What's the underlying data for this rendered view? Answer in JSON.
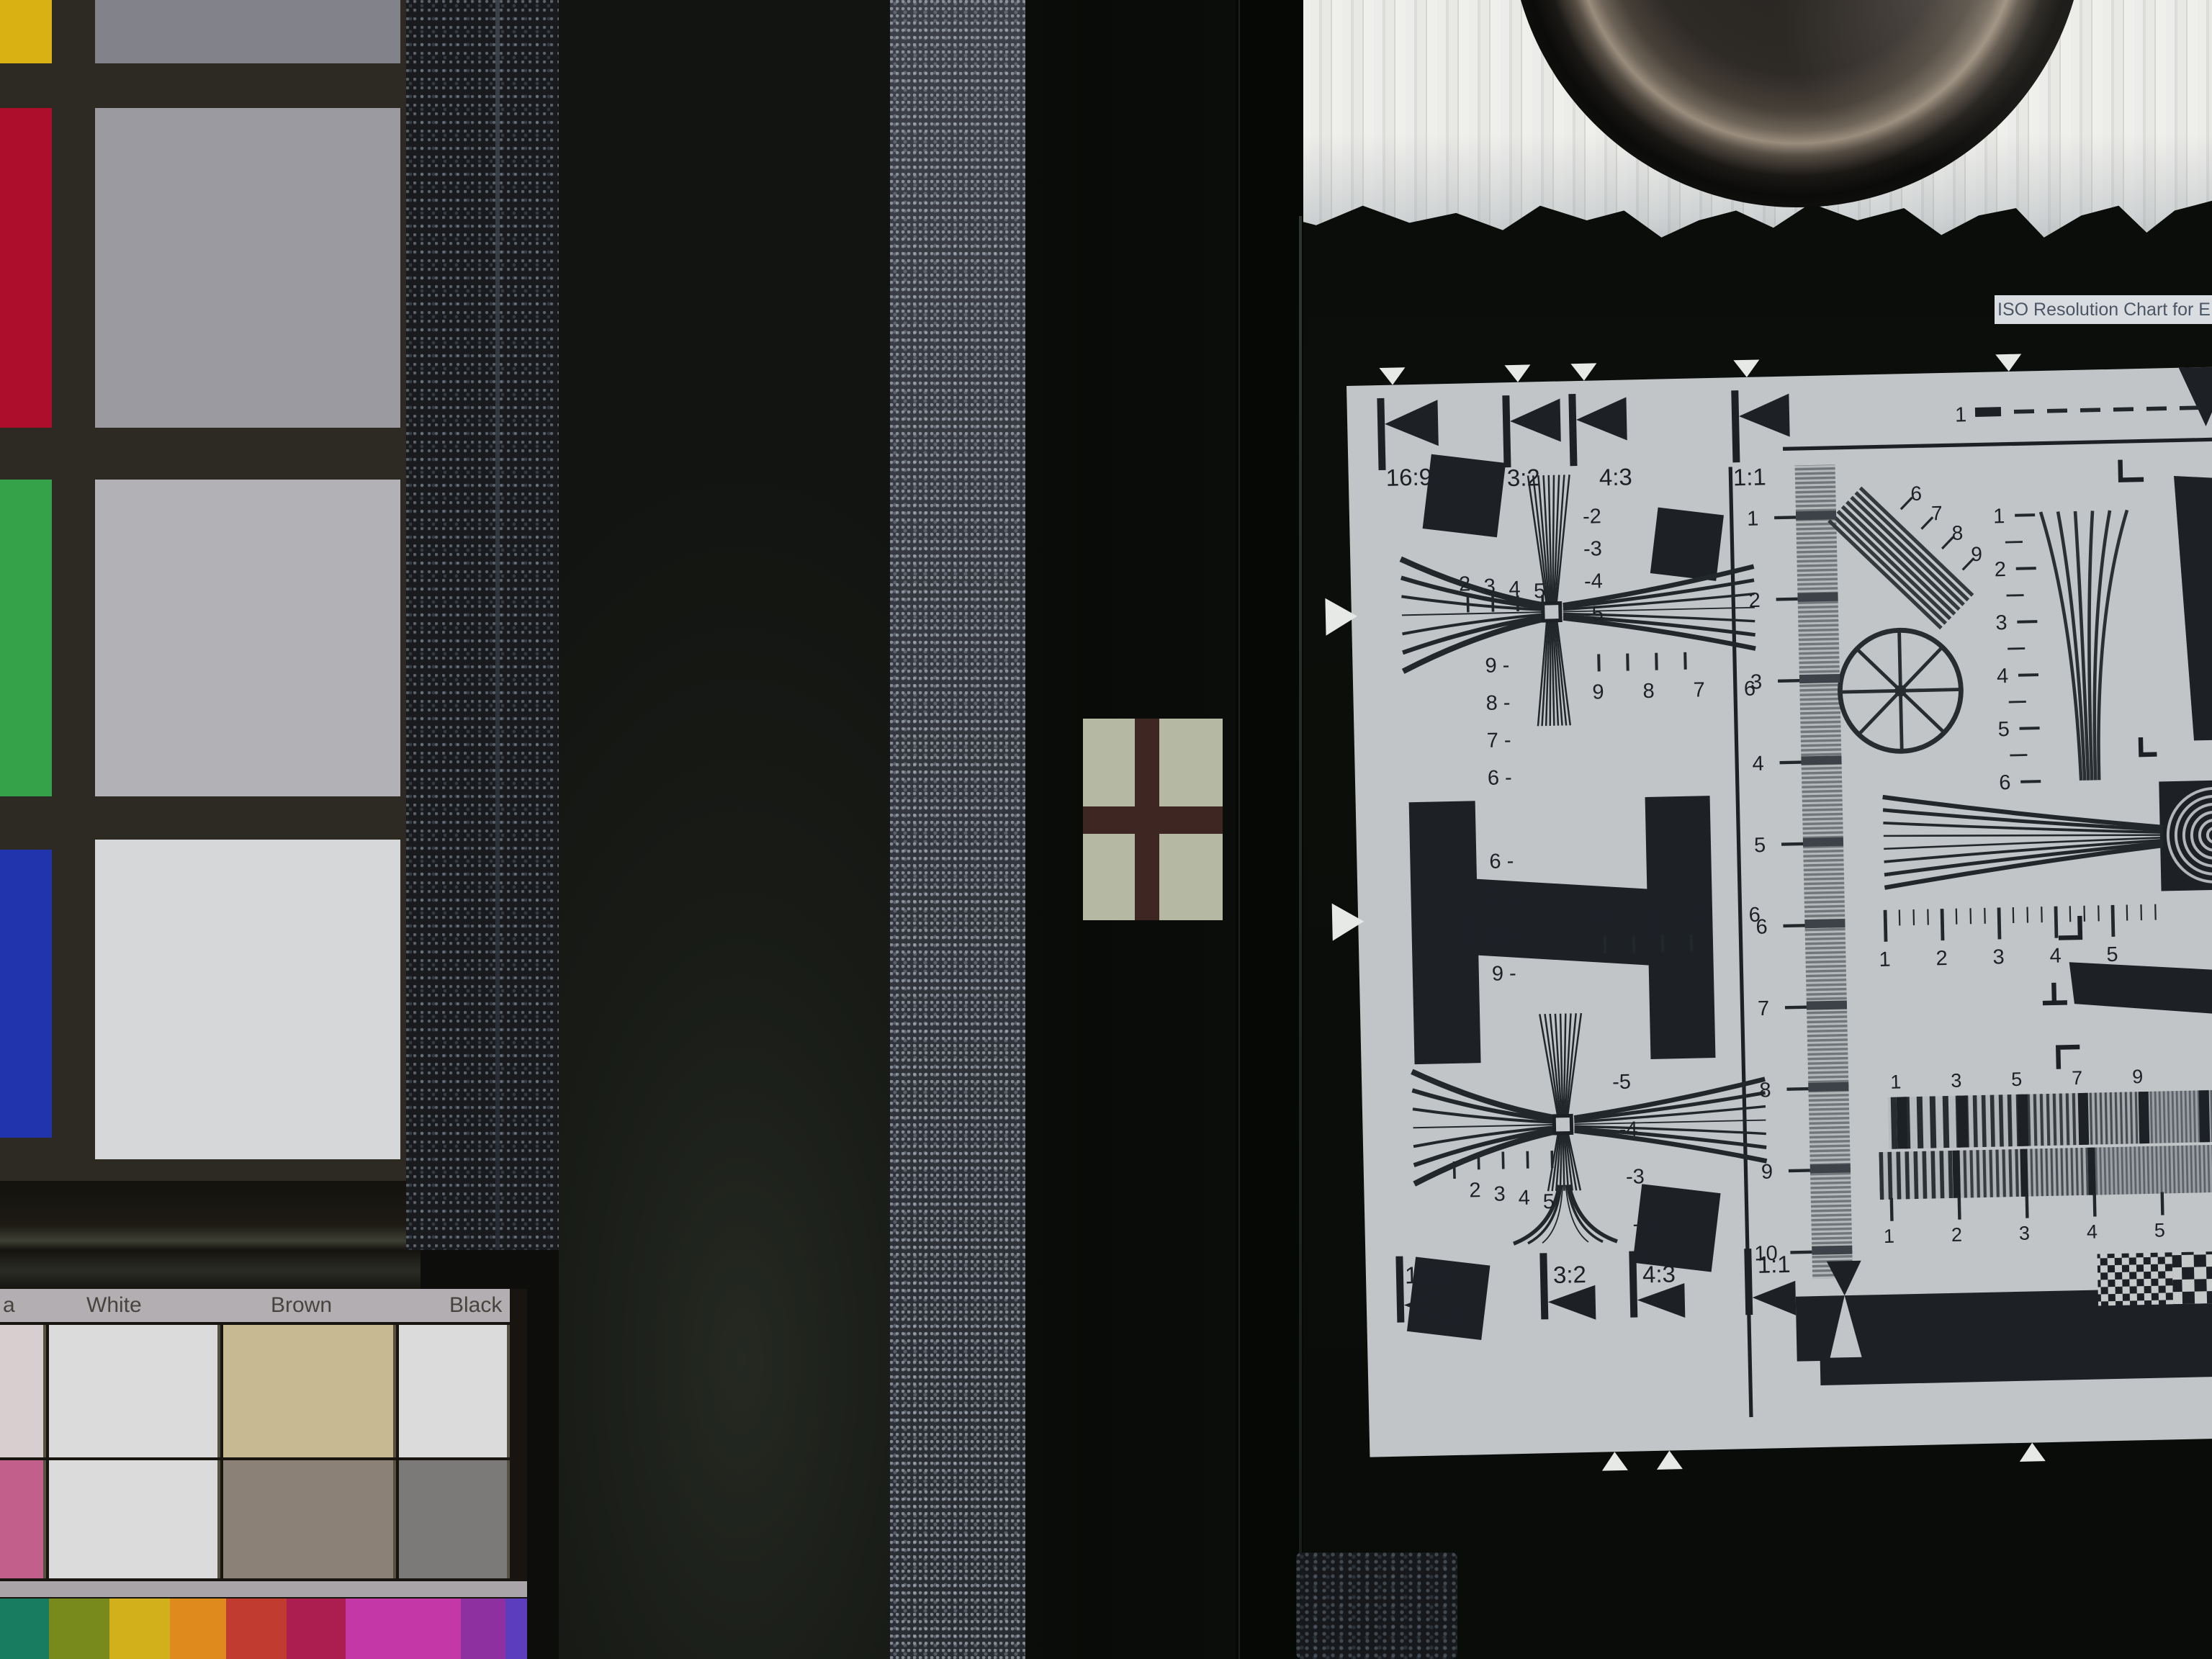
{
  "scene": {
    "description": "camera test lab: color checker, panels, cross target, ISO resolution chart"
  },
  "left_panel": {
    "color_checker": {
      "column1": [
        {
          "name": "yellow",
          "color": "#d9b113"
        },
        {
          "name": "red",
          "color": "#ad0e2b"
        },
        {
          "name": "green",
          "color": "#35a149"
        },
        {
          "name": "blue",
          "color": "#2134ad"
        }
      ],
      "column2": [
        {
          "name": "gray-1",
          "color": "#82828a"
        },
        {
          "name": "gray-2",
          "color": "#9a9aa0"
        },
        {
          "name": "gray-3",
          "color": "#b2b2b6"
        },
        {
          "name": "white",
          "color": "#d6d7d9"
        }
      ],
      "frame_color": "#2d2a24"
    },
    "paint_chart": {
      "labels": [
        "a",
        "White",
        "Brown",
        "Black"
      ],
      "row_top": [
        "#d8ced0",
        "#dbdbdc",
        "#c7ba92",
        "#dbdbdc"
      ],
      "row_bottom": [
        "#c25f8a",
        "#dbdbdc",
        "#8b8177",
        "#7b7a78"
      ],
      "bars": [
        "#177c60",
        "#798a1d",
        "#d2b01b",
        "#df8a1c",
        "#c23b31",
        "#ad1e50",
        "#c437a6",
        "#8e30a0",
        "#5b3dbd"
      ]
    },
    "cross_target": {
      "bg": "#b5b9a4",
      "cross": "#3e2722"
    }
  },
  "iso_chart": {
    "caption": "ISO Resolution Chart for E",
    "aspect_top": [
      "16:9",
      "3:2",
      "4:3",
      "1:1"
    ],
    "aspect_bottom": [
      "16:9",
      "3:2",
      "4:3",
      "1:1"
    ],
    "dash_label": "1",
    "ruler": [
      "1",
      "2",
      "3",
      "4",
      "5",
      "6",
      "7",
      "8",
      "9",
      "10"
    ],
    "right_wedge": [
      "1",
      "2",
      "3",
      "4",
      "5",
      "6"
    ],
    "fan_ruler": [
      "1",
      "2",
      "3",
      "4",
      "5"
    ],
    "band_upper": [
      "1",
      "3",
      "5",
      "7",
      "9"
    ],
    "band_lower": [
      "1",
      "2",
      "3",
      "4",
      "5"
    ],
    "burst": [
      "6",
      "7",
      "8",
      "9"
    ],
    "upper_cross": {
      "neg": [
        "-2",
        "-3",
        "-4",
        "-5"
      ],
      "left": [
        "2",
        "3",
        "4",
        "5"
      ],
      "col": [
        "9 -",
        "8 -",
        "7 -",
        "6 -"
      ],
      "row": "9 8 7 6"
    },
    "lower_cross": {
      "neg": [
        "-5",
        "-4",
        "-3",
        "-2"
      ],
      "left": [
        "2",
        "3",
        "4",
        "5"
      ],
      "col": [
        "6 -",
        "7 -",
        "8 -",
        "9 -"
      ],
      "row": "9 8 7 6"
    },
    "paper_color": "#c2c5c7",
    "ink_color": "#1d2126"
  }
}
